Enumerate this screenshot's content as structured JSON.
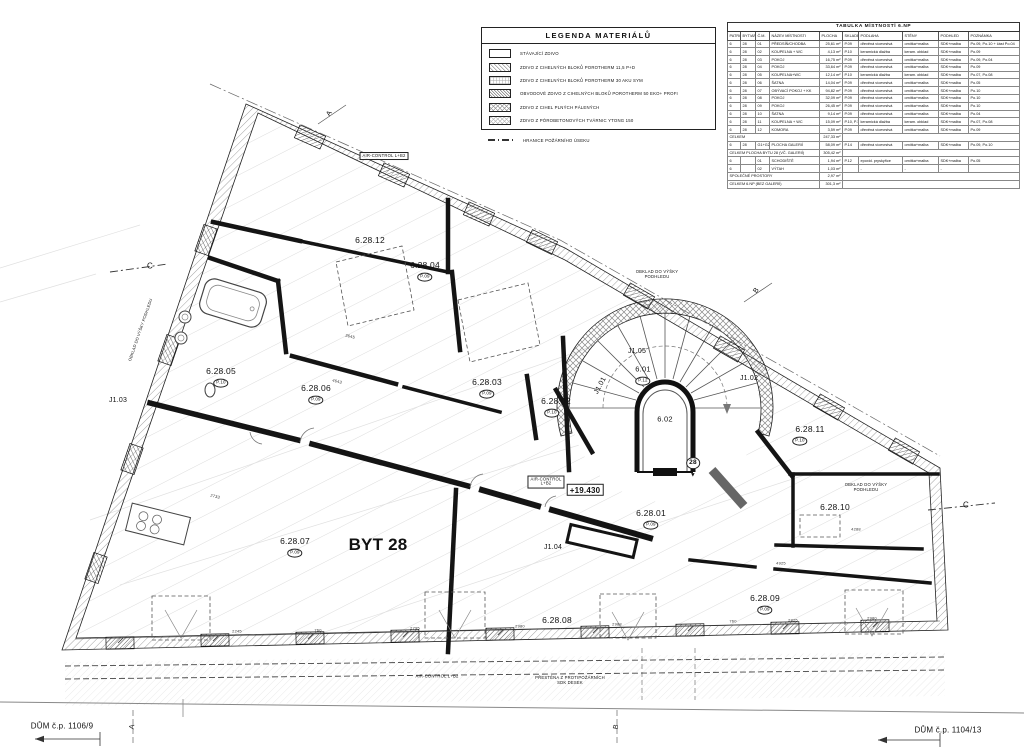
{
  "legend": {
    "title": "LEGENDA MATERIÁLŮ",
    "items": [
      {
        "label": "STÁVAJÍCÍ ZDIVO",
        "swatch": "plain"
      },
      {
        "label": "ZDIVO Z CIHELNÝCH BLOKŮ POROTHERM 11,5 P+D",
        "swatch": "hatch"
      },
      {
        "label": "ZDIVO Z CIHELNÝCH BLOKŮ POROTHERM 30 AKU SYM",
        "swatch": "grid"
      },
      {
        "label": "OBVODOVÉ ZDIVO Z CIHELNÝCH BLOKŮ POROTHERM 50 EKO+ PROFI",
        "swatch": "dense"
      },
      {
        "label": "ZDIVO Z CIHEL PLNÝCH PÁLENÝCH",
        "swatch": "cross"
      },
      {
        "label": "ZDIVO Z PÓROBETONOVÝCH TVÁRNIC YTONG 150",
        "swatch": "cross2"
      },
      {
        "label": "HRANICE POŽÁRNÍHO ÚSEKU",
        "swatch": "dashline"
      }
    ]
  },
  "room_table": {
    "title": "TABULKA MÍSTNOSTÍ 6.NP",
    "columns": [
      "PATRO",
      "BYT/AP",
      "Č.M.",
      "NÁZEV MÍSTNOSTI",
      "PLOCHA",
      "SKLADBA",
      "PODLAHA",
      "STĚNY",
      "PODHLED",
      "POZNÁMKA"
    ],
    "rows": [
      {
        "cells": [
          "6",
          "28",
          "01",
          "PŘEDSÍŇ/CHODBA",
          "25,61 m²",
          "P.09",
          "dřevěná vícevrstvá",
          "omítka+malba",
          "SDK+malba",
          "Po.09, Po.10 + část Po.04"
        ]
      },
      {
        "cells": [
          "6",
          "28",
          "02",
          "KOUPELNA + WC",
          "4,13 m²",
          "P.10",
          "keramická dlažba",
          "keram. obklad",
          "SDK+malba",
          "Po.09"
        ]
      },
      {
        "cells": [
          "6",
          "28",
          "03",
          "POKOJ",
          "16,75 m²",
          "P.09",
          "dřevěná vícevrstvá",
          "omítka+malba",
          "SDK+malba",
          "Po.09, Po.04"
        ]
      },
      {
        "cells": [
          "6",
          "28",
          "04",
          "POKOJ",
          "33,64 m²",
          "P.09",
          "dřevěná vícevrstvá",
          "omítka+malba",
          "SDK+malba",
          "Po.09"
        ]
      },
      {
        "cells": [
          "6",
          "28",
          "05",
          "KOUPELNA+WC",
          "12,14 m²",
          "P.10",
          "keramická dlažba",
          "keram. obklad",
          "SDK+malba",
          "Po.07, Po.08"
        ]
      },
      {
        "cells": [
          "6",
          "28",
          "06",
          "ŠATNA",
          "14,04 m²",
          "P.09",
          "dřevěná vícevrstvá",
          "omítka+malba",
          "SDK+malba",
          "Po.05"
        ]
      },
      {
        "cells": [
          "6",
          "28",
          "07",
          "OBÝVACÍ POKOJ + KK",
          "94,82 m²",
          "P.09",
          "dřevěná vícevrstvá",
          "omítka+malba",
          "SDK+malba",
          "Po.10"
        ]
      },
      {
        "cells": [
          "6",
          "28",
          "08",
          "POKOJ",
          "32,09 m²",
          "P.09",
          "dřevěná vícevrstvá",
          "omítka+malba",
          "SDK+malba",
          "Po.10"
        ]
      },
      {
        "cells": [
          "6",
          "28",
          "09",
          "POKOJ",
          "26,45 m²",
          "P.09",
          "dřevěná vícevrstvá",
          "omítka+malba",
          "SDK+malba",
          "Po.10"
        ]
      },
      {
        "cells": [
          "6",
          "28",
          "10",
          "ŠATNA",
          "9,14 m²",
          "P.09",
          "dřevěná vícevrstvá",
          "omítka+malba",
          "SDK+malba",
          "Po.04"
        ]
      },
      {
        "cells": [
          "6",
          "28",
          "11",
          "KOUPELNA + WC",
          "15,09 m²",
          "P.10, P.15",
          "keramická dlažba",
          "keram. obklad",
          "SDK+malba",
          "Po.07, Po.08"
        ]
      },
      {
        "cells": [
          "6",
          "28",
          "12",
          "KOMORA",
          "3,59 m²",
          "P.09",
          "dřevěná vícevrstvá",
          "omítka+malba",
          "SDK+malba",
          "Po.09"
        ]
      },
      {
        "total": true,
        "label": "CELKEM",
        "value": "247,33 m²"
      },
      {
        "cells": [
          "6",
          "28",
          "G1+G2",
          "PLOCHA GALERIÍ",
          "58,09 m²",
          "P.14",
          "dřevěná vícevrstvá",
          "omítka+malba",
          "SDK+malba",
          "Po.09, Po.10"
        ]
      },
      {
        "total": true,
        "label": "CELKEM PLOCHA BYTU 28 (VČ. GALERIÍ)",
        "value": "305,42 m²"
      },
      {
        "cells": [
          "6",
          "",
          "01",
          "SCHODIŠTĚ",
          "1,94 m²",
          "P.12",
          "epoxid. pryskyřice",
          "omítka+malba",
          "SDK+malba",
          "Po.05"
        ]
      },
      {
        "cells": [
          "6",
          "",
          "02",
          "VÝTAH",
          "1,03 m²",
          "",
          "-",
          "-",
          "-",
          ""
        ]
      },
      {
        "total": true,
        "label": "SPOLEČNÉ PROSTORY",
        "value": "2,97 m²"
      },
      {
        "total": true,
        "label": "CELKEM 6.NP (BEZ GALERIÍ)",
        "value": "301,3 m²"
      }
    ]
  },
  "plan": {
    "labels": [
      {
        "t": "6.28.12",
        "x": 370,
        "y": 240,
        "n": "room-label-6-28-12"
      },
      {
        "t": "6.28.04",
        "x": 425,
        "y": 265,
        "n": "room-label-6-28-04"
      },
      {
        "t": "P.09",
        "x": 425,
        "y": 277,
        "fs": 4.5,
        "badge": 1,
        "n": "floor-spec-badge"
      },
      {
        "t": "6.28.05",
        "x": 221,
        "y": 371,
        "n": "room-label-6-28-05"
      },
      {
        "t": "P.10",
        "x": 221,
        "y": 383,
        "fs": 4.5,
        "badge": 1,
        "n": "floor-spec-badge"
      },
      {
        "t": "6.28.06",
        "x": 316,
        "y": 388,
        "n": "room-label-6-28-06"
      },
      {
        "t": "P.09",
        "x": 316,
        "y": 400,
        "fs": 4.5,
        "badge": 1,
        "n": "floor-spec-badge"
      },
      {
        "t": "6.28.03",
        "x": 487,
        "y": 382,
        "n": "room-label-6-28-03"
      },
      {
        "t": "P.09",
        "x": 487,
        "y": 394,
        "fs": 4.5,
        "badge": 1,
        "n": "floor-spec-badge"
      },
      {
        "t": "6.28.02",
        "x": 556,
        "y": 401,
        "n": "room-label-6-28-02"
      },
      {
        "t": "P.10",
        "x": 552,
        "y": 413,
        "fs": 4.5,
        "badge": 1,
        "n": "floor-spec-badge"
      },
      {
        "t": "6.01",
        "x": 643,
        "y": 370,
        "fs": 7.5,
        "n": "room-label-6-01"
      },
      {
        "t": "P.12",
        "x": 643,
        "y": 381,
        "fs": 4.5,
        "badge": 1,
        "n": "floor-spec-badge"
      },
      {
        "t": "6.02",
        "x": 665,
        "y": 420,
        "fs": 7.5,
        "n": "room-label-6-02"
      },
      {
        "t": "J1.05",
        "x": 637,
        "y": 352,
        "fs": 7,
        "n": "room-label-j1-05"
      },
      {
        "t": "J1.01",
        "x": 601,
        "y": 386,
        "fs": 7,
        "r": -62,
        "n": "room-label-j1-01"
      },
      {
        "t": "J1.02",
        "x": 749,
        "y": 379,
        "fs": 7,
        "n": "room-label-j1-02"
      },
      {
        "t": "J1.03",
        "x": 118,
        "y": 401,
        "fs": 7,
        "n": "room-label-j1-03"
      },
      {
        "t": "J1.04",
        "x": 553,
        "y": 548,
        "fs": 7,
        "n": "room-label-j1-04"
      },
      {
        "t": "6.28.11",
        "x": 810,
        "y": 429,
        "n": "room-label-6-28-11"
      },
      {
        "t": "P.10",
        "x": 800,
        "y": 441,
        "fs": 4.5,
        "badge": 1,
        "n": "floor-spec-badge"
      },
      {
        "t": "6.28.10",
        "x": 835,
        "y": 507,
        "n": "room-label-6-28-10"
      },
      {
        "t": "6.28.01",
        "x": 651,
        "y": 513,
        "n": "room-label-6-28-01"
      },
      {
        "t": "P.09",
        "x": 651,
        "y": 525,
        "fs": 4.5,
        "badge": 1,
        "n": "floor-spec-badge"
      },
      {
        "t": "6.28.07",
        "x": 295,
        "y": 541,
        "n": "room-label-6-28-07"
      },
      {
        "t": "P.09",
        "x": 295,
        "y": 553,
        "fs": 4.5,
        "badge": 1,
        "n": "floor-spec-badge"
      },
      {
        "t": "6.28.08",
        "x": 557,
        "y": 620,
        "n": "room-label-6-28-08"
      },
      {
        "t": "6.28.09",
        "x": 765,
        "y": 598,
        "n": "room-label-6-28-09"
      },
      {
        "t": "P.09",
        "x": 765,
        "y": 610,
        "fs": 4.5,
        "badge": 1,
        "n": "floor-spec-badge"
      },
      {
        "t": "BYT 28",
        "x": 378,
        "y": 545,
        "fs": 17,
        "b": 1,
        "n": "apartment-label"
      },
      {
        "t": "+19.430",
        "x": 585,
        "y": 490,
        "fs": 8,
        "b": 1,
        "box": 1,
        "n": "level-elevation-label"
      },
      {
        "t": "28",
        "x": 693,
        "y": 463,
        "fs": 6.5,
        "b": 1,
        "badge": 1,
        "n": "entrance-number-badge"
      },
      {
        "t": "▼",
        "x": 693,
        "y": 476,
        "fs": 6,
        "n": "entrance-arrow"
      },
      {
        "t": "OBKLAD DO VÝŠKY\nPODHLEDU",
        "x": 657,
        "y": 275,
        "fs": 4.2,
        "n": "note-tiling-height"
      },
      {
        "t": "OBKLAD DO VÝŠKY\nPODHLEDU",
        "x": 866,
        "y": 488,
        "fs": 4.2,
        "n": "note-tiling-height"
      },
      {
        "t": "OBKLAD DO VÝŠKY PODHLEDU",
        "x": 141,
        "y": 330,
        "fs": 4,
        "r": -71,
        "n": "note-tiling-height"
      },
      {
        "t": "AIR-CONTROL L+B2",
        "x": 384,
        "y": 156,
        "fs": 4.2,
        "box": 1,
        "n": "note-air-control"
      },
      {
        "t": "AIR-CONTROL\nL+B2",
        "x": 546,
        "y": 482,
        "fs": 4.2,
        "box": 1,
        "n": "note-air-control"
      },
      {
        "t": "AIR-CONTROL L+B2",
        "x": 437,
        "y": 677,
        "fs": 4.2,
        "n": "note-air-control"
      },
      {
        "t": "PŘESTĚNA Z PROTIPOŽÁRNÍCH\nSDK DESEK",
        "x": 570,
        "y": 681,
        "fs": 4.2,
        "n": "note-fire-partition"
      },
      {
        "t": "DŮM č.p. 1106/9",
        "x": 62,
        "y": 726,
        "fs": 8,
        "n": "building-label-left"
      },
      {
        "t": "DŮM č.p. 1104/13",
        "x": 948,
        "y": 730,
        "fs": 8,
        "n": "building-label-right"
      },
      {
        "t": "C",
        "x": 150,
        "y": 266,
        "fs": 8,
        "n": "section-marker-c-left"
      },
      {
        "t": "C",
        "x": 966,
        "y": 505,
        "fs": 8,
        "n": "section-marker-c-right"
      },
      {
        "t": "A",
        "x": 330,
        "y": 114,
        "fs": 7,
        "r": -55,
        "n": "axis-marker"
      },
      {
        "t": "B",
        "x": 757,
        "y": 291,
        "fs": 7,
        "r": -55,
        "n": "axis-marker"
      },
      {
        "t": "A",
        "x": 133,
        "y": 727,
        "fs": 7,
        "r": -80,
        "n": "axis-marker"
      },
      {
        "t": "B",
        "x": 617,
        "y": 727,
        "fs": 7,
        "r": -80,
        "n": "axis-marker"
      },
      {
        "t": "2245",
        "x": 237,
        "y": 632,
        "fs": 4,
        "dim": 1,
        "n": "dimension"
      },
      {
        "t": "760",
        "x": 318,
        "y": 631,
        "fs": 4,
        "dim": 1,
        "n": "dimension"
      },
      {
        "t": "2795",
        "x": 415,
        "y": 629,
        "fs": 4,
        "dim": 1,
        "n": "dimension"
      },
      {
        "t": "2980",
        "x": 520,
        "y": 627,
        "fs": 4,
        "dim": 1,
        "n": "dimension"
      },
      {
        "t": "2988",
        "x": 617,
        "y": 625,
        "fs": 4,
        "dim": 1,
        "n": "dimension"
      },
      {
        "t": "760",
        "x": 733,
        "y": 622,
        "fs": 4,
        "dim": 1,
        "n": "dimension"
      },
      {
        "t": "2825",
        "x": 793,
        "y": 621,
        "fs": 4,
        "dim": 1,
        "n": "dimension"
      },
      {
        "t": "2980",
        "x": 872,
        "y": 619,
        "fs": 4,
        "dim": 1,
        "n": "dimension"
      },
      {
        "t": "4288",
        "x": 856,
        "y": 530,
        "fs": 4,
        "dim": 1,
        "n": "dimension"
      },
      {
        "t": "4925",
        "x": 781,
        "y": 564,
        "fs": 4,
        "dim": 1,
        "n": "dimension"
      },
      {
        "t": "3645",
        "x": 350,
        "y": 337,
        "fs": 4,
        "r": 14,
        "dim": 1,
        "n": "dimension"
      },
      {
        "t": "4643",
        "x": 337,
        "y": 382,
        "fs": 4,
        "r": 14,
        "dim": 1,
        "n": "dimension"
      },
      {
        "t": "2733",
        "x": 215,
        "y": 497,
        "fs": 4,
        "r": 14,
        "dim": 1,
        "n": "dimension"
      }
    ]
  }
}
